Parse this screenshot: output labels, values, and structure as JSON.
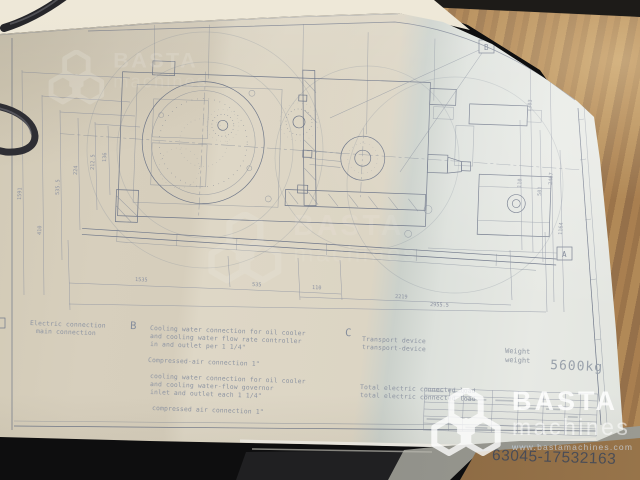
{
  "photo": {
    "watermark": {
      "brand": "BASTA",
      "sub": "machines",
      "url": "www.bastamachines.com"
    },
    "listing_id": "63045-17532163"
  },
  "drawing": {
    "callouts": {
      "top": "B",
      "right": "A"
    },
    "legend": {
      "a": {
        "line1": "Electric connection",
        "line2": "main connection"
      },
      "b": {
        "letter": "B",
        "l1": "Cooling water connection for oil cooler",
        "l2": "and cooling water flow rate controller",
        "l3": "in and outlet per 1 1/4\"",
        "air1": "Compressed-air connection 1\"",
        "l4": "cooling water connection for oil cooler",
        "l5": "and cooling water-flow governor",
        "l6": "inlet and outlet each 1 1/4\"",
        "air2": "compressed air connection 1\""
      },
      "c": {
        "letter": "C",
        "l1": "Transport device",
        "l2": "transport-device",
        "t1": "Total electric connected load",
        "t2": "total electric connected load"
      },
      "weight": {
        "w1": "Weight",
        "w2": "weight",
        "value": "5600kg"
      }
    },
    "dimensions": {
      "bottom": [
        "1535",
        "535",
        "110",
        "2219",
        "2955.5"
      ],
      "left": [
        "136",
        "212.5",
        "224",
        "535.5",
        "410",
        "1591"
      ],
      "right": [
        "1303",
        "501",
        "110",
        "2467",
        "1164"
      ]
    }
  }
}
